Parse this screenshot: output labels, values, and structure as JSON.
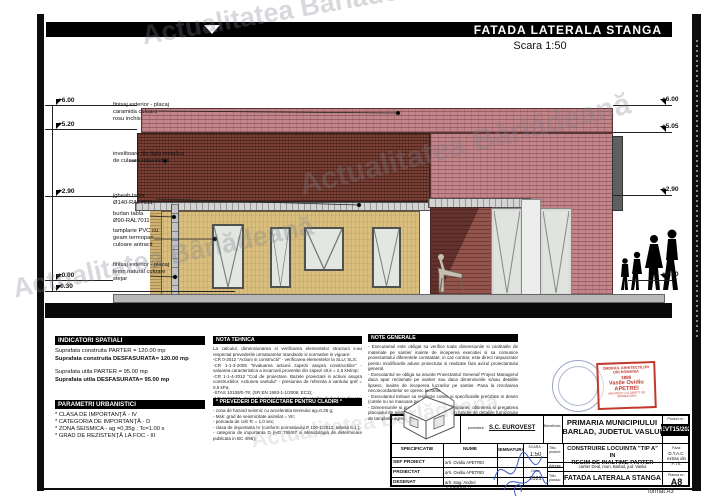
{
  "sheet": {
    "title": "FATADA LATERALA STANGA",
    "scale": "Scara 1:50",
    "watermark": "Actualitatea Bârlădeană",
    "format": "format A3"
  },
  "colors": {
    "brick_pink": "#c28589",
    "roof_red": "#7c4034",
    "wall_yellow": "#d9be7e",
    "stamp_red": "#c0392b",
    "signature_blue": "#3a57c4"
  },
  "markers_left": [
    "+6.00",
    "+5.20",
    "+2.90",
    "±0.00",
    "-0.30"
  ],
  "markers_right": [
    "+6.00",
    "+5.05",
    "+2.90",
    "+0.10"
  ],
  "annotations": [
    "finisaj exterior - placaj\ncaramida culoare\nrosu inchis",
    "invelitoare din tigla metalica\nde culoare rosu inchis",
    "jgheab tabla\nØ140-RAL7011",
    "burlan tabla\nØ90-RAL7011",
    "tamplarie PVC cu\ngeam termopan\nculoare antracit",
    "finisaj exterior - placaj\nlemn natural culoare\nstejar"
  ],
  "sections": {
    "indicatori": {
      "title": "INDICATORI SPATIALI",
      "lines": [
        "Suprafata construita PARTER = 120.00 mp",
        "Suprafata construita DESFASURATA= 120.00 mp",
        "Suprafata utila PARTER = 95.00 mp",
        "Suprafata utila DESFASURATA= 95.00 mp"
      ]
    },
    "parametri": {
      "title": "PARAMETRI URBANISTICI",
      "lines": [
        "* CLASA DE IMPORTANŢĂ - IV",
        "* CATEGORIA DE IMPORTANŢĂ - D",
        "* ZONA SEISMICA - ag =0,35g ; Tc=1.00 s",
        "* GRAD DE REZISTENŢĂ LA FOC - III"
      ]
    },
    "nota_tehnica": {
      "title": "NOTA TEHNICA",
      "body": "La calculul, dimensionarea si verificarea elementelor structurii s-au respectat prevederile urmatoarelor standarde si normative in vigoare:\n-CR 0-2012 \"Actiuni in constructii\" - verificarea elementelor la SLU; SLS;\n-CR 1-1-3-2005 \"Evaluarea actiunii zapezii asupra constructiilor\" - valoarea caracteristica a incarcarii provenite din zapezi s0,k = 2,5 kN/mp;\n-CR 1-1-4-2012 \"Cod de proiectare. Bazele proiectarii si actiuni asupra constructiilor. Actiunea vantului\" - presiunea de referinta a vantului qref = 0,6 kPa;\n-STAS 10108/0-78; (SR EN 1993-1-1/2006; EC3);\n-NP 112/2004 - Normativ privind proiectarea structurilor de fundare directa;\nCod de proiectare seismica P100 - Partea 1 - P100-1/2013."
    },
    "prevederi": {
      "title": "* PREVEDERI DE PROIECTARE PENTRU CLADIRI *",
      "body": "- zona de hazard seismic cu acceleratia terenului ag=0,35 g;\n- Msk: grad de seismicitate asimilat = VII;\n- perioada de colt Tc = 1,0 sec;\n- clasa de importanta IV (conform normativului P 100-1/2013; tabelul 6.1.);\n- categoria de importanta D (HG 766/97 si Metodologia de determinare publicata in BC 4/96);"
    },
    "note_generale": {
      "title": "NOTE GENERALE",
      "body": "- Executantul este obligat sa verifice toate dimensiunile si cantitatile de materiale pe santier inainte de inceperea executiei si sa comunice proiectantului diferentele constatate; in caz contrar, este direct raspunzator pentru modificarile aduse proiectului si realizate fara avizul proiectantului general.\n- Executantul se obliga sa anunte Proiectantul General/ Project Managerul daca apar reclamatii pe santier sau daca dimensiunile si/sau detaliile lipsesc, inainte de inceperea lucrarilor pe santier. Pana la rezolvarea neconcordantelor se opresc lucrarile.\n- Executantul trebuie sa respecte cotele si specificatiile precizate in desen (cotele nu se masoara pe planuri).\n- Dimensiunile si pozitionarea exacta a tamplariei, obtinerea si pregatirea placajului de piatra si lemn vor fi adaptate in functie de detaliile furnizorului de tamplarie agreat."
    }
  },
  "stamp": {
    "org": "ORDINUL ARHITECTILOR\nDIN ROMANIA",
    "number": "3886",
    "name": "Vasile Ovidiu\nAPETREI",
    "footer": "ARHITECT CU DREPT DE SEMNATURA"
  },
  "titleblock": {
    "proiectant_label": "proiectant:",
    "proiectant": "S.C. EUROVEST S.R.L.",
    "proiectant_info": "inregistrata la Registrul Comertului\nmun. Barlad, jud. Vaslui",
    "beneficiar_label": "Beneficiar:",
    "beneficiar": "PRIMARIA MUNICIPIULUI\nBARLAD, JUDETUL VASLUI",
    "proiect_label": "Proiect nr.:",
    "proiect_nr": "EVT15/2021",
    "col_specificatie": "SPECIFICATIE",
    "col_nume": "NUME",
    "col_semnatura": "SEMNATURA",
    "scara_label": "SCARA :",
    "scara_value": "1:50",
    "data_label": "Data:",
    "data_value": "2021",
    "rows": [
      {
        "spec": "SEF PROIECT",
        "nume": "arh. Ovidiu APETREI"
      },
      {
        "spec": "PROIECTAT",
        "nume": "arh. Ovidiu APETREI"
      },
      {
        "spec": "DESENAT",
        "nume": "arh. stag. Andrei TODERASCU"
      }
    ],
    "titlu_proiect_label": "Titlu proiect:",
    "titlu_proiect": "CONSTRUIRE LOCUINTA \"TIP A\" IN\nREGIM DE INALTIME PARTER",
    "adresa_label": "Adresa:",
    "adresa": "cartier Deal, mun. Barlad, jud. Vaslui",
    "titlu_plansa_label": "Titlu plansa:",
    "titlu_plansa": "FATADA LATERALA STANGA",
    "faza_label": "Faza:",
    "faza_value": "D.T.A.C.\nextras din\nP.Th.",
    "plansa_label": "Plansa nr.:",
    "plansa_value": "A8"
  }
}
